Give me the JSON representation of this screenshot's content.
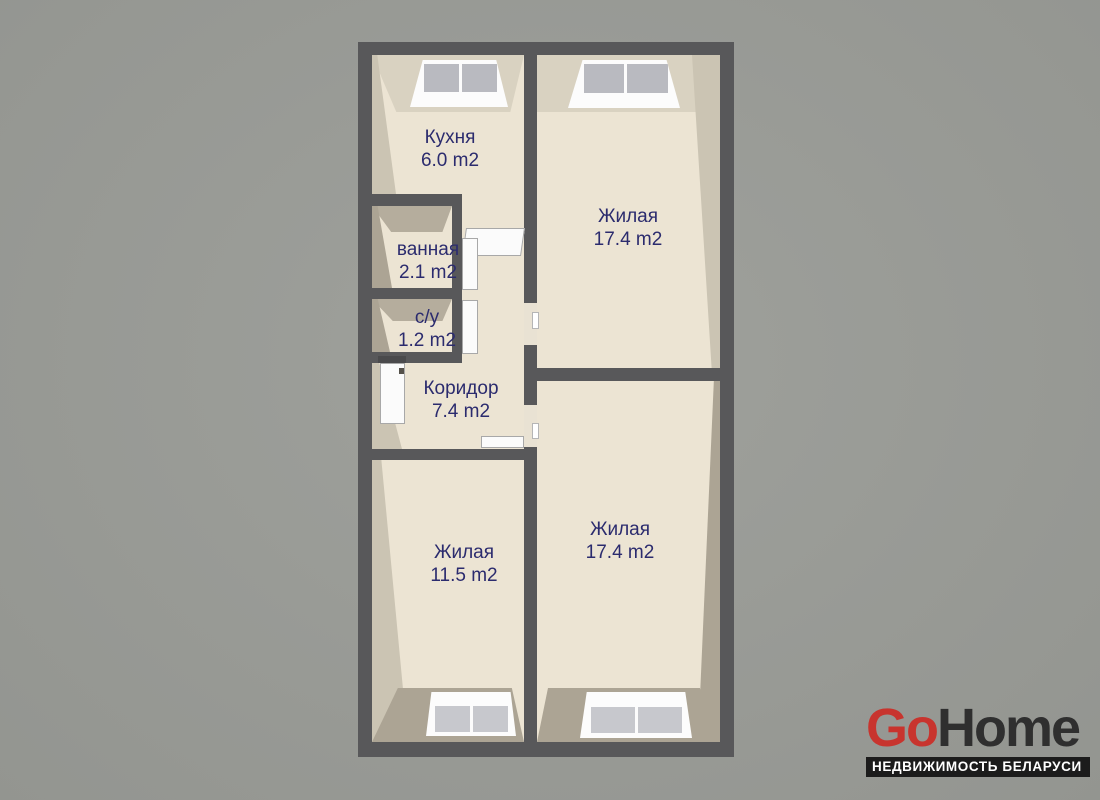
{
  "background_color": "#9b9d98",
  "plan": {
    "wall_color": "#58585a",
    "floor_color": "#ece4d3",
    "label_color": "#2b2b6e",
    "rooms": [
      {
        "name": "Кухня",
        "area": "6.0 m2"
      },
      {
        "name": "Жилая",
        "area": "17.4 m2"
      },
      {
        "name": "ванная",
        "area": "2.1 m2"
      },
      {
        "name": "с/у",
        "area": "1.2 m2"
      },
      {
        "name": "Коридор",
        "area": "7.4 m2"
      },
      {
        "name": "Жилая",
        "area": "11.5 m2"
      },
      {
        "name": "Жилая",
        "area": "17.4 m2"
      }
    ]
  },
  "logo": {
    "go": "Go",
    "home": "Home",
    "tagline": "НЕДВИЖИМОСТЬ БЕЛАРУСИ",
    "go_color": "#c8342e",
    "home_color": "#2f2f2f"
  }
}
